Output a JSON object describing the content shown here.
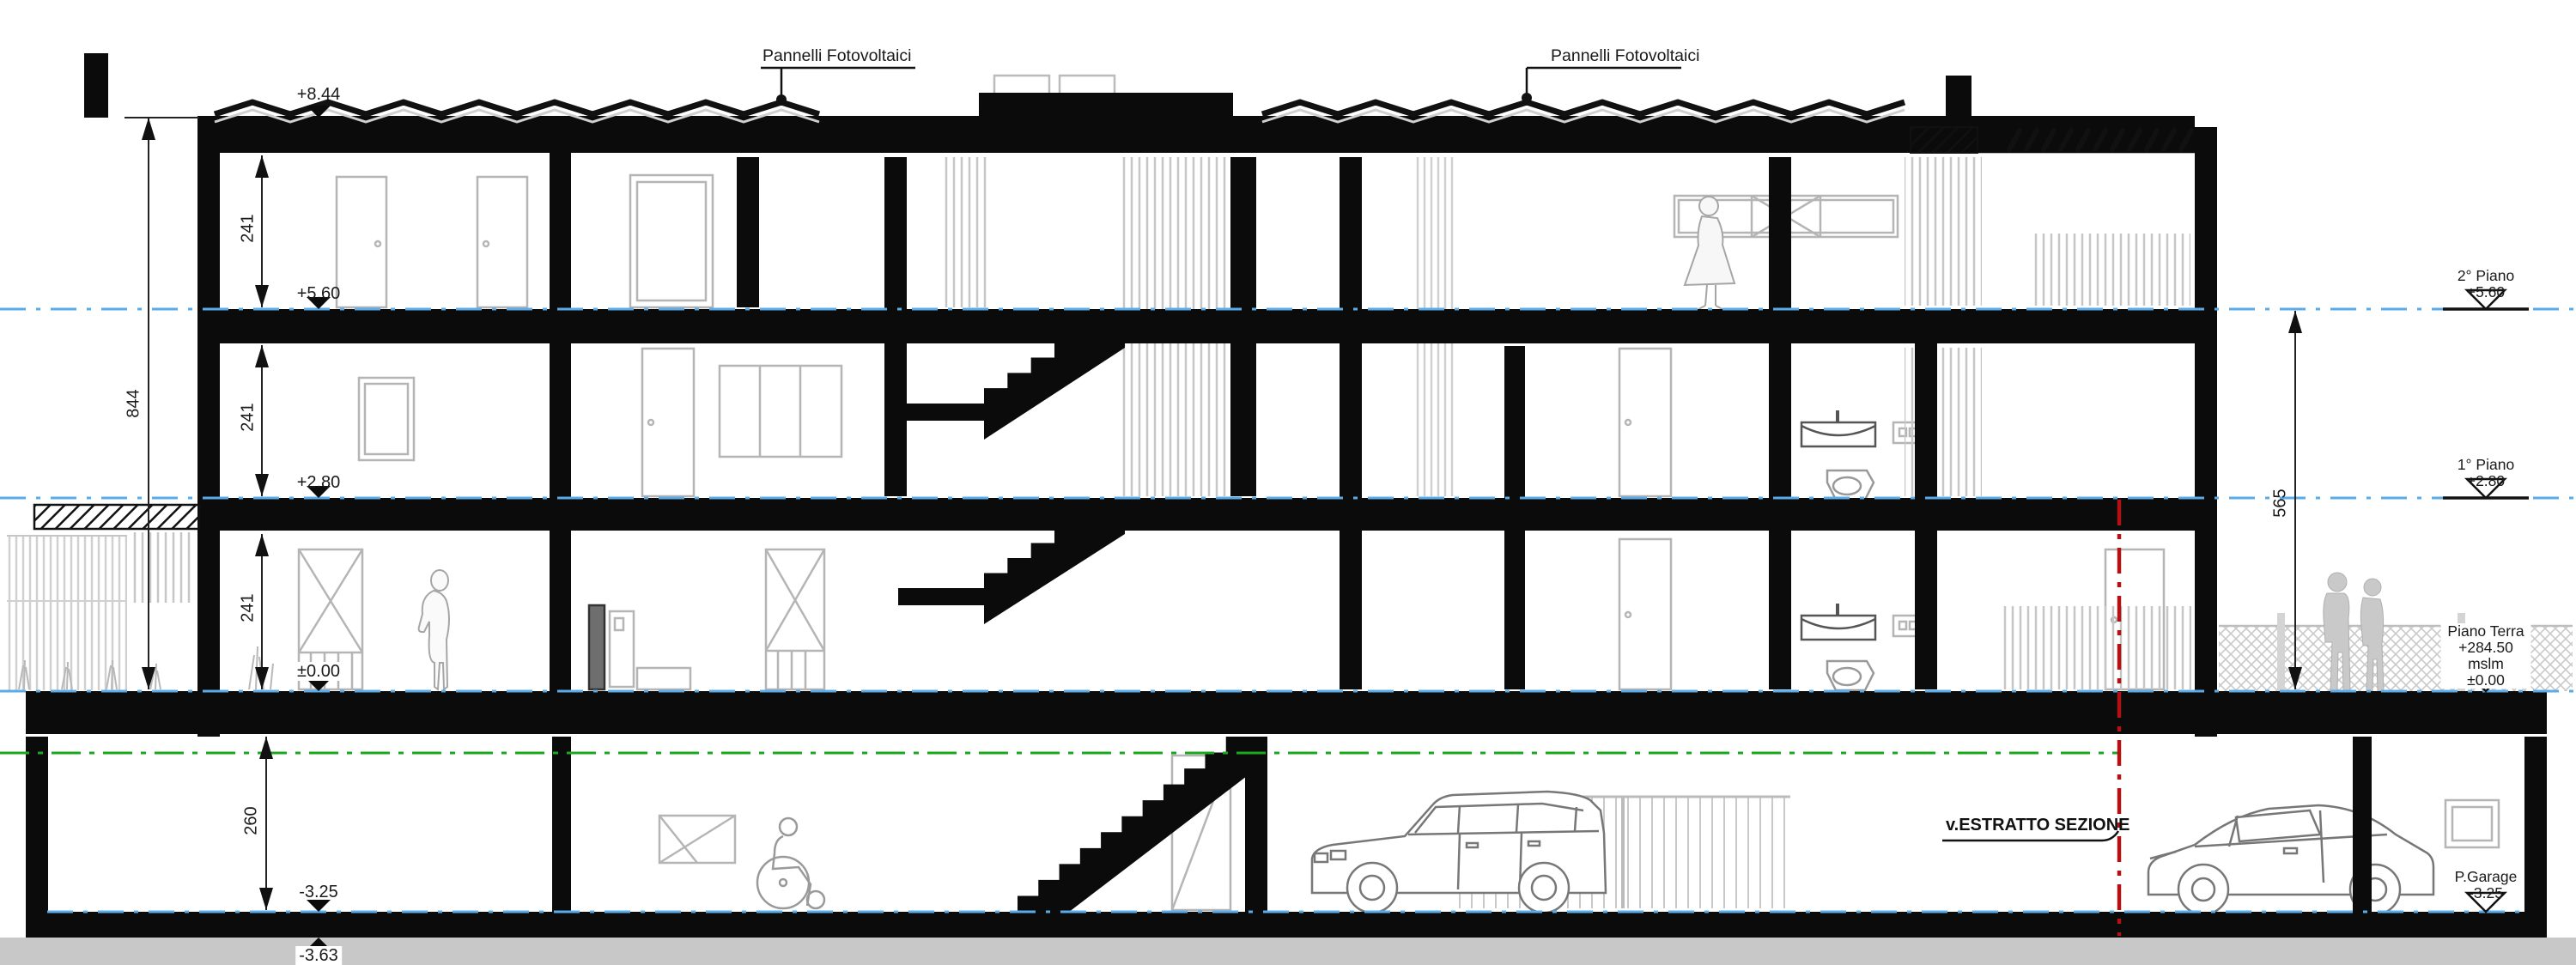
{
  "annotations": {
    "pv_left": "Pannelli Fotovoltaici",
    "pv_right": "Pannelli Fotovoltaici",
    "section_ref": "v.ESTRATTO SEZIONE"
  },
  "elevation_marks": {
    "roof": "+8.44",
    "floor2": "+5.60",
    "floor1": "+2.80",
    "ground": "±0.00",
    "garage": "-3.25",
    "foundation": "-3.63"
  },
  "levels": [
    {
      "name": "2° Piano",
      "elevation": "+5.60"
    },
    {
      "name": "1° Piano",
      "elevation": "+2.80"
    },
    {
      "name": "Piano Terra",
      "altitude": "+284.50 mslm",
      "elevation": "±0.00"
    },
    {
      "name": "P.Garage",
      "elevation": "-3.25"
    }
  ],
  "dimensions": {
    "storey_2": "241",
    "storey_1": "241",
    "storey_ground": "241",
    "total_height": "844",
    "upper_floors_right": "565",
    "garage_height": "260"
  },
  "colors": {
    "level_line_blue": "#5aabe8",
    "terrain_line_green": "#1ca81c",
    "section_line_red": "#b41212",
    "earth_gray": "#c8c8c8",
    "detail_gray": "#c0c0c0"
  }
}
